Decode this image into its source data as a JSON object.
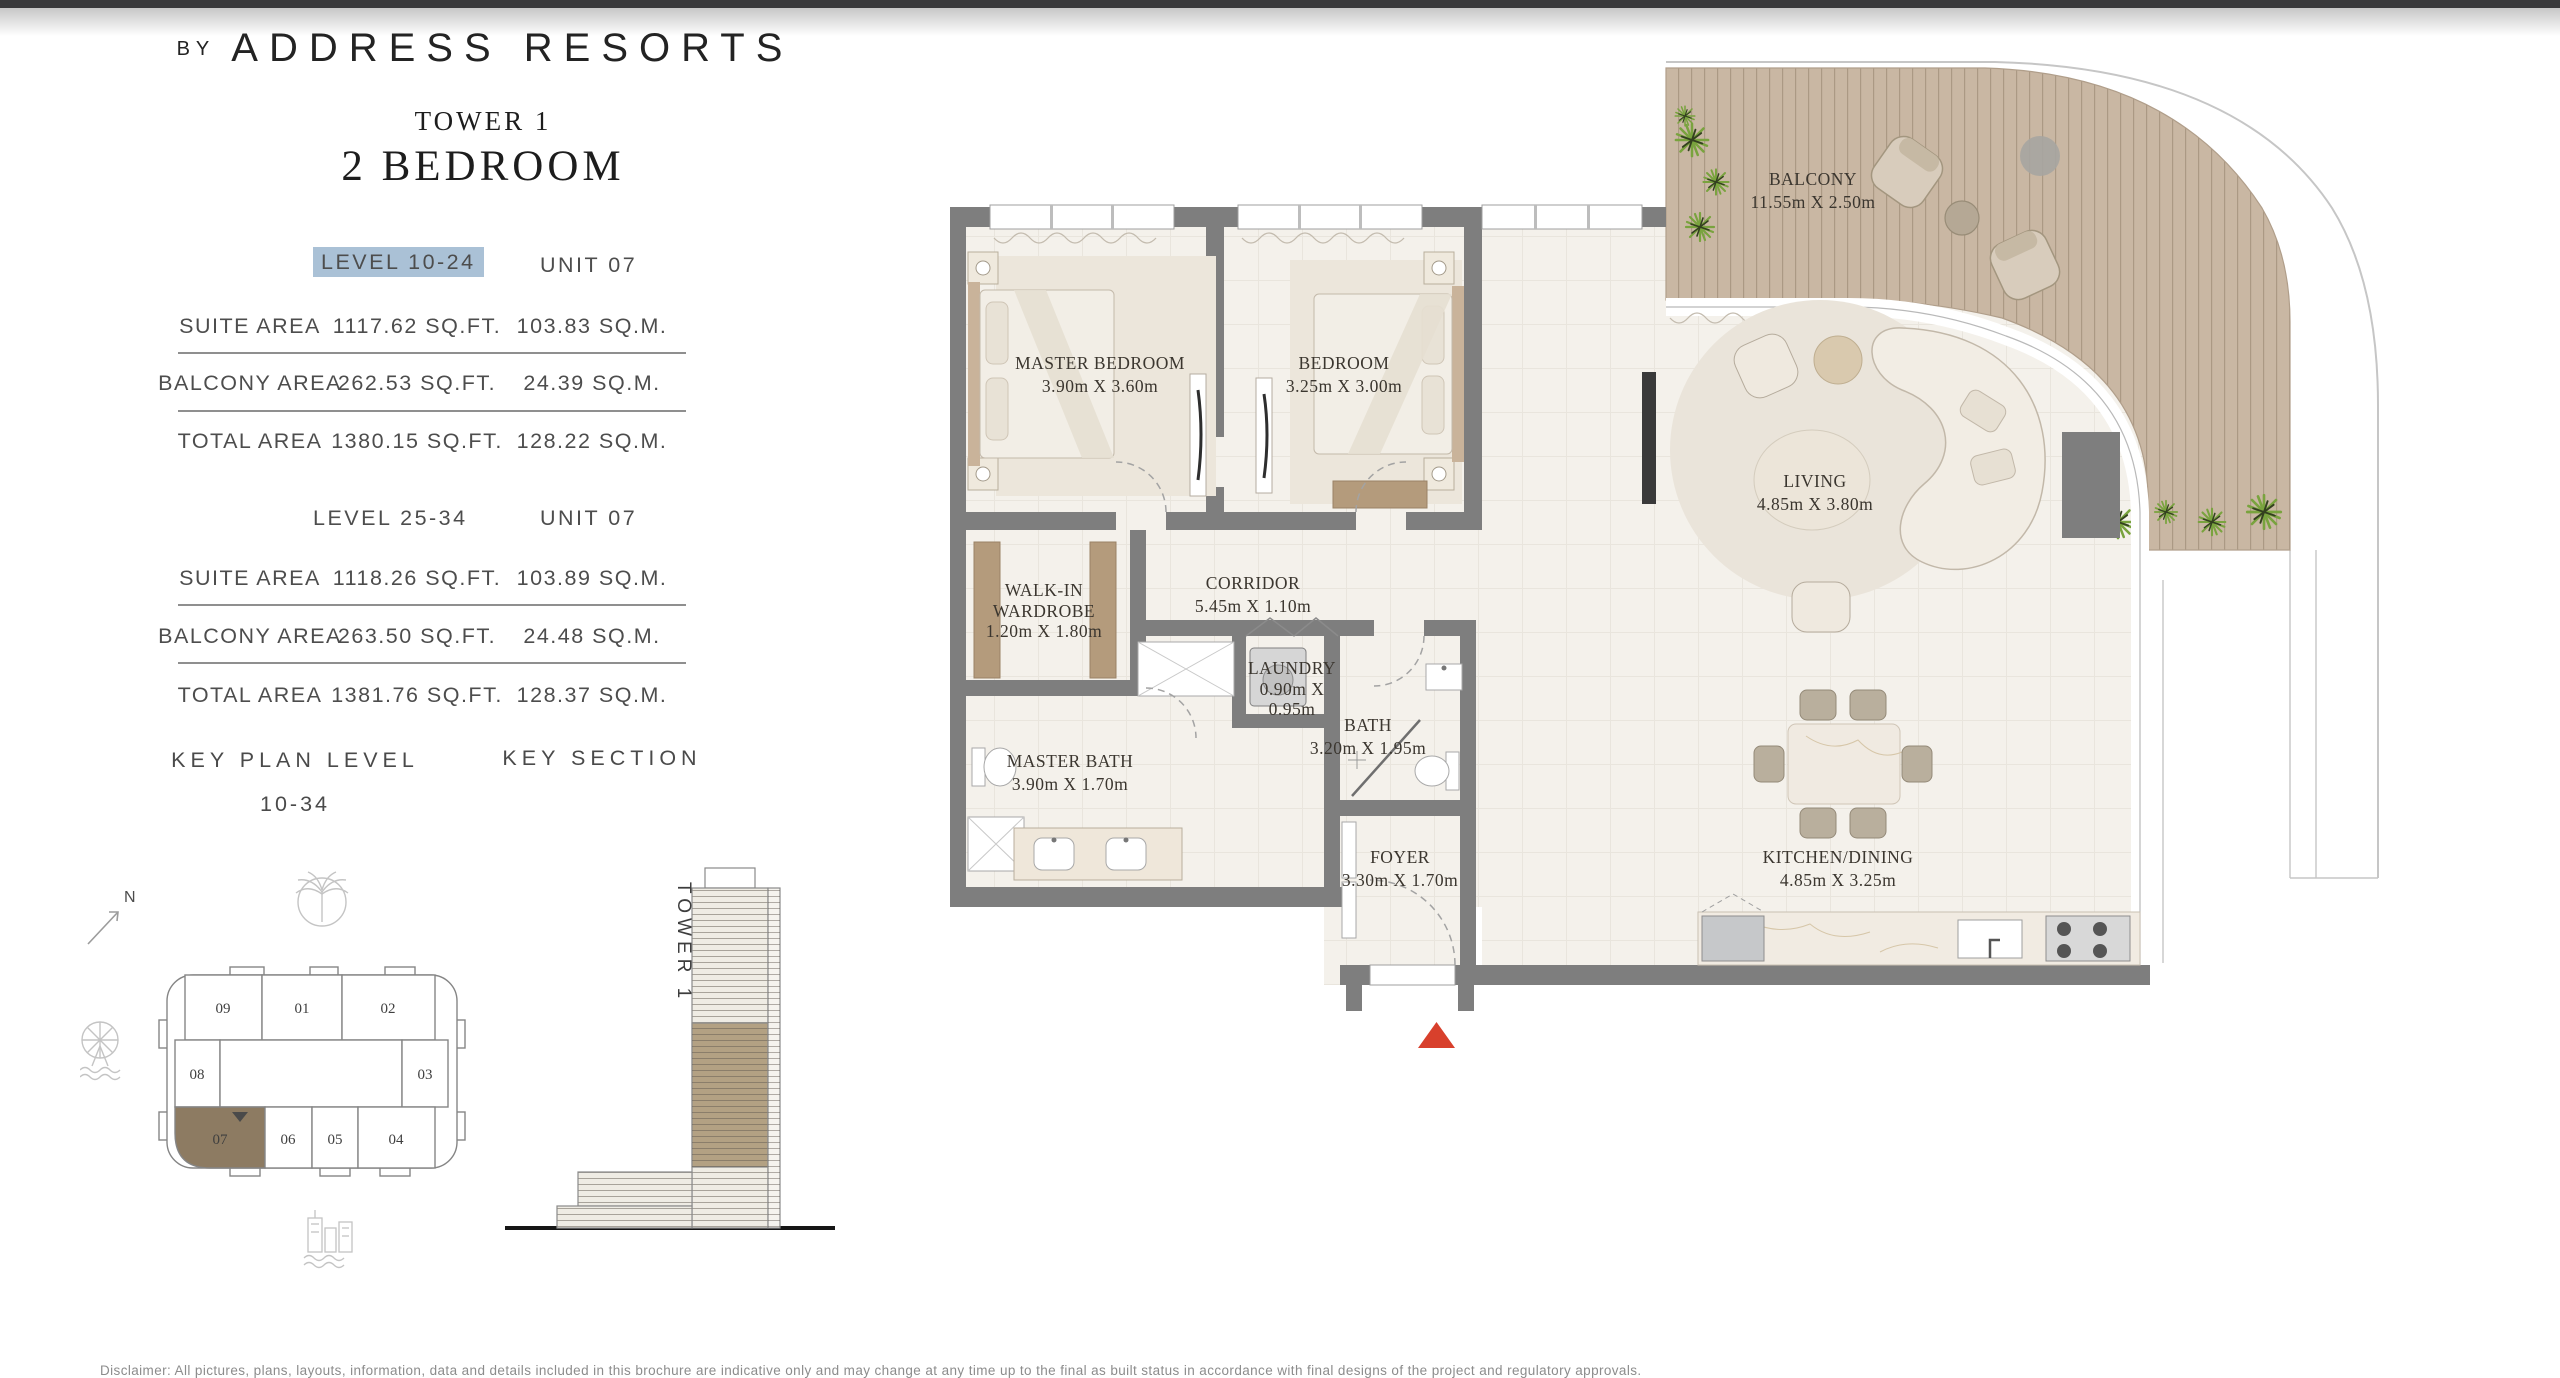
{
  "brand": {
    "prefix": "BY",
    "name": "ADDRESS RESORTS"
  },
  "plan_header": {
    "tower": "TOWER 1",
    "bedrooms": "2 BEDROOM"
  },
  "spec_blocks": [
    {
      "level": "LEVEL 10-24",
      "unit": "UNIT 07",
      "level_highlighted": true,
      "rows": [
        {
          "label": "SUITE AREA",
          "imperial": "1117.62 SQ.FT.",
          "metric": "103.83 SQ.M."
        },
        {
          "label": "BALCONY AREA",
          "imperial": "262.53 SQ.FT.",
          "metric": "24.39 SQ.M."
        },
        {
          "label": "TOTAL AREA",
          "imperial": "1380.15 SQ.FT.",
          "metric": "128.22 SQ.M."
        }
      ]
    },
    {
      "level": "LEVEL 25-34",
      "unit": "UNIT 07",
      "level_highlighted": false,
      "rows": [
        {
          "label": "SUITE AREA",
          "imperial": "1118.26 SQ.FT.",
          "metric": "103.89 SQ.M."
        },
        {
          "label": "BALCONY AREA",
          "imperial": "263.50 SQ.FT.",
          "metric": "24.48 SQ.M."
        },
        {
          "label": "TOTAL AREA",
          "imperial": "1381.76 SQ.FT.",
          "metric": "128.37 SQ.M."
        }
      ]
    }
  ],
  "key_plan": {
    "title": "KEY PLAN LEVEL",
    "range": "10-34",
    "compass_label": "N",
    "highlighted_unit": "07",
    "units": [
      {
        "id": "09"
      },
      {
        "id": "01"
      },
      {
        "id": "02"
      },
      {
        "id": "08"
      },
      {
        "id": "03"
      },
      {
        "id": "07"
      },
      {
        "id": "06"
      },
      {
        "id": "05"
      },
      {
        "id": "04"
      }
    ]
  },
  "key_section": {
    "title": "KEY SECTION",
    "tower_label": "TOWER 1"
  },
  "floor_plan": {
    "rooms": [
      {
        "lines": [
          "BALCONY",
          "11.55m X 2.50m"
        ]
      },
      {
        "lines": [
          "MASTER BEDROOM",
          "3.90m X 3.60m"
        ]
      },
      {
        "lines": [
          "BEDROOM",
          "3.25m X 3.00m"
        ]
      },
      {
        "lines": [
          "LIVING",
          "4.85m X 3.80m"
        ]
      },
      {
        "lines": [
          "CORRIDOR",
          "5.45m X 1.10m"
        ]
      },
      {
        "lines": [
          "WALK-IN",
          "WARDROBE",
          "1.20m X 1.80m"
        ]
      },
      {
        "lines": [
          "LAUNDRY",
          "0.90m X",
          "0.95m"
        ]
      },
      {
        "lines": [
          "BATH",
          "3.20m X 1.95m"
        ]
      },
      {
        "lines": [
          "MASTER BATH",
          "3.90m X 1.70m"
        ]
      },
      {
        "lines": [
          "FOYER",
          "3.30m X 1.70m"
        ]
      },
      {
        "lines": [
          "KITCHEN/DINING",
          "4.85m X 3.25m"
        ]
      }
    ],
    "entrance_marker_color": "#d8402c"
  },
  "colors": {
    "highlight": "#aac1d6",
    "wall": "#7e7e7e",
    "deck": "#c9b7a3",
    "floor": "#f4f1eb",
    "key_unit_fill": "#8d7b62",
    "accent_red": "#d8402c"
  },
  "disclaimer": "Disclaimer: All pictures, plans, layouts, information, data and details included in this brochure are indicative only and may change at any time up to the final as built status in accordance with final designs of the project and regulatory approvals."
}
